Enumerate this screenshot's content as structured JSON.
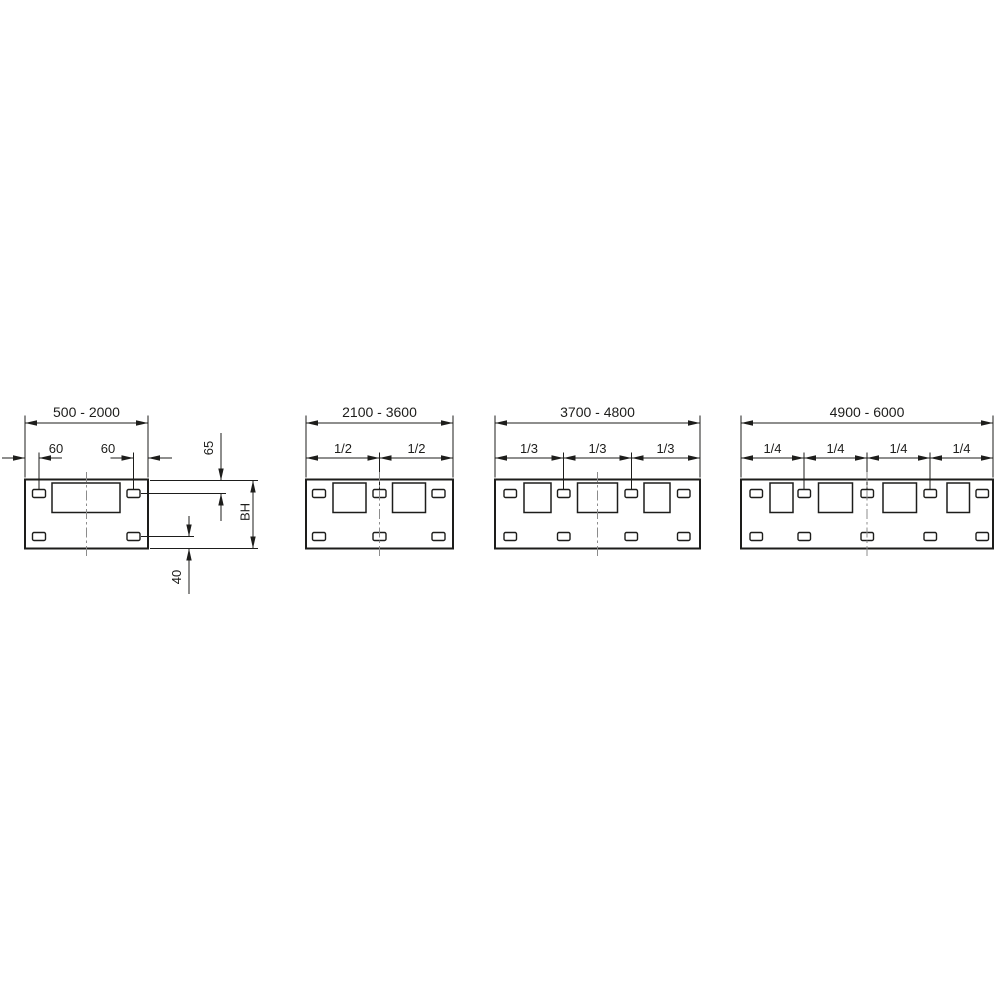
{
  "colors": {
    "line": "#1d1d1b",
    "centerline": "#8c8c8c",
    "background": "#ffffff"
  },
  "diagrams": [
    {
      "range": "500 - 2000",
      "dimensions": {
        "left_slot_offset": "60",
        "right_slot_offset": "60",
        "slot_center_from_top": "65",
        "plate_height": "BH",
        "slot_center_from_bottom": "40"
      },
      "cutout_count": 1,
      "slot_count_top": 2,
      "slot_count_bottom": 2
    },
    {
      "range": "2100 - 3600",
      "segment_labels": [
        "1/2",
        "1/2"
      ],
      "cutout_count": 2,
      "slot_count_top": 3,
      "slot_count_bottom": 3
    },
    {
      "range": "3700 - 4800",
      "segment_labels": [
        "1/3",
        "1/3",
        "1/3"
      ],
      "cutout_count": 3,
      "slot_count_top": 4,
      "slot_count_bottom": 4
    },
    {
      "range": "4900 - 6000",
      "segment_labels": [
        "1/4",
        "1/4",
        "1/4",
        "1/4"
      ],
      "cutout_count": 4,
      "slot_count_top": 5,
      "slot_count_bottom": 5
    }
  ]
}
